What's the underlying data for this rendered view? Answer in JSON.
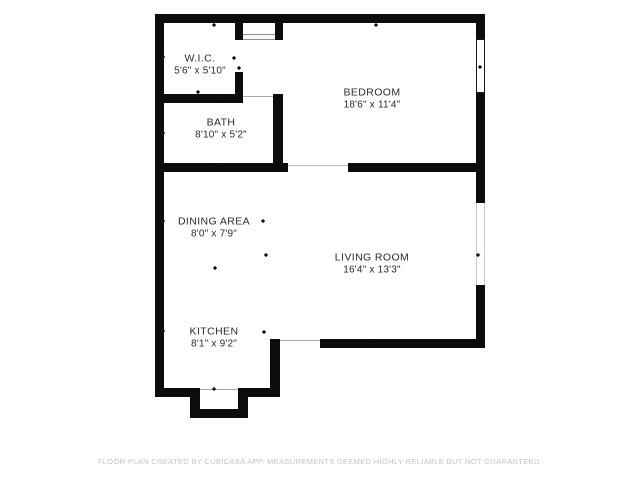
{
  "floor_plan": {
    "rooms": [
      {
        "name": "W.I.C.",
        "dims": "5'6\" x 5'10\""
      },
      {
        "name": "BATH",
        "dims": "8'10\" x 5'2\""
      },
      {
        "name": "BEDROOM",
        "dims": "18'6\" x 11'4\""
      },
      {
        "name": "DINING AREA",
        "dims": "8'0\" x 7'9\""
      },
      {
        "name": "LIVING ROOM",
        "dims": "16'4\" x 13'3\""
      },
      {
        "name": "KITCHEN",
        "dims": "8'1\" x 9'2\""
      }
    ],
    "footer": "FLOOR PLAN CREATED BY CUBICASA APP. MEASUREMENTS DEEMED HIGHLY RELIABLE BUT NOT GUARANTEED.",
    "colors": {
      "wall": "#0c0c0c",
      "label": "#2b2b2b",
      "footer_text": "#c5c5c5",
      "background": "#ffffff"
    }
  }
}
